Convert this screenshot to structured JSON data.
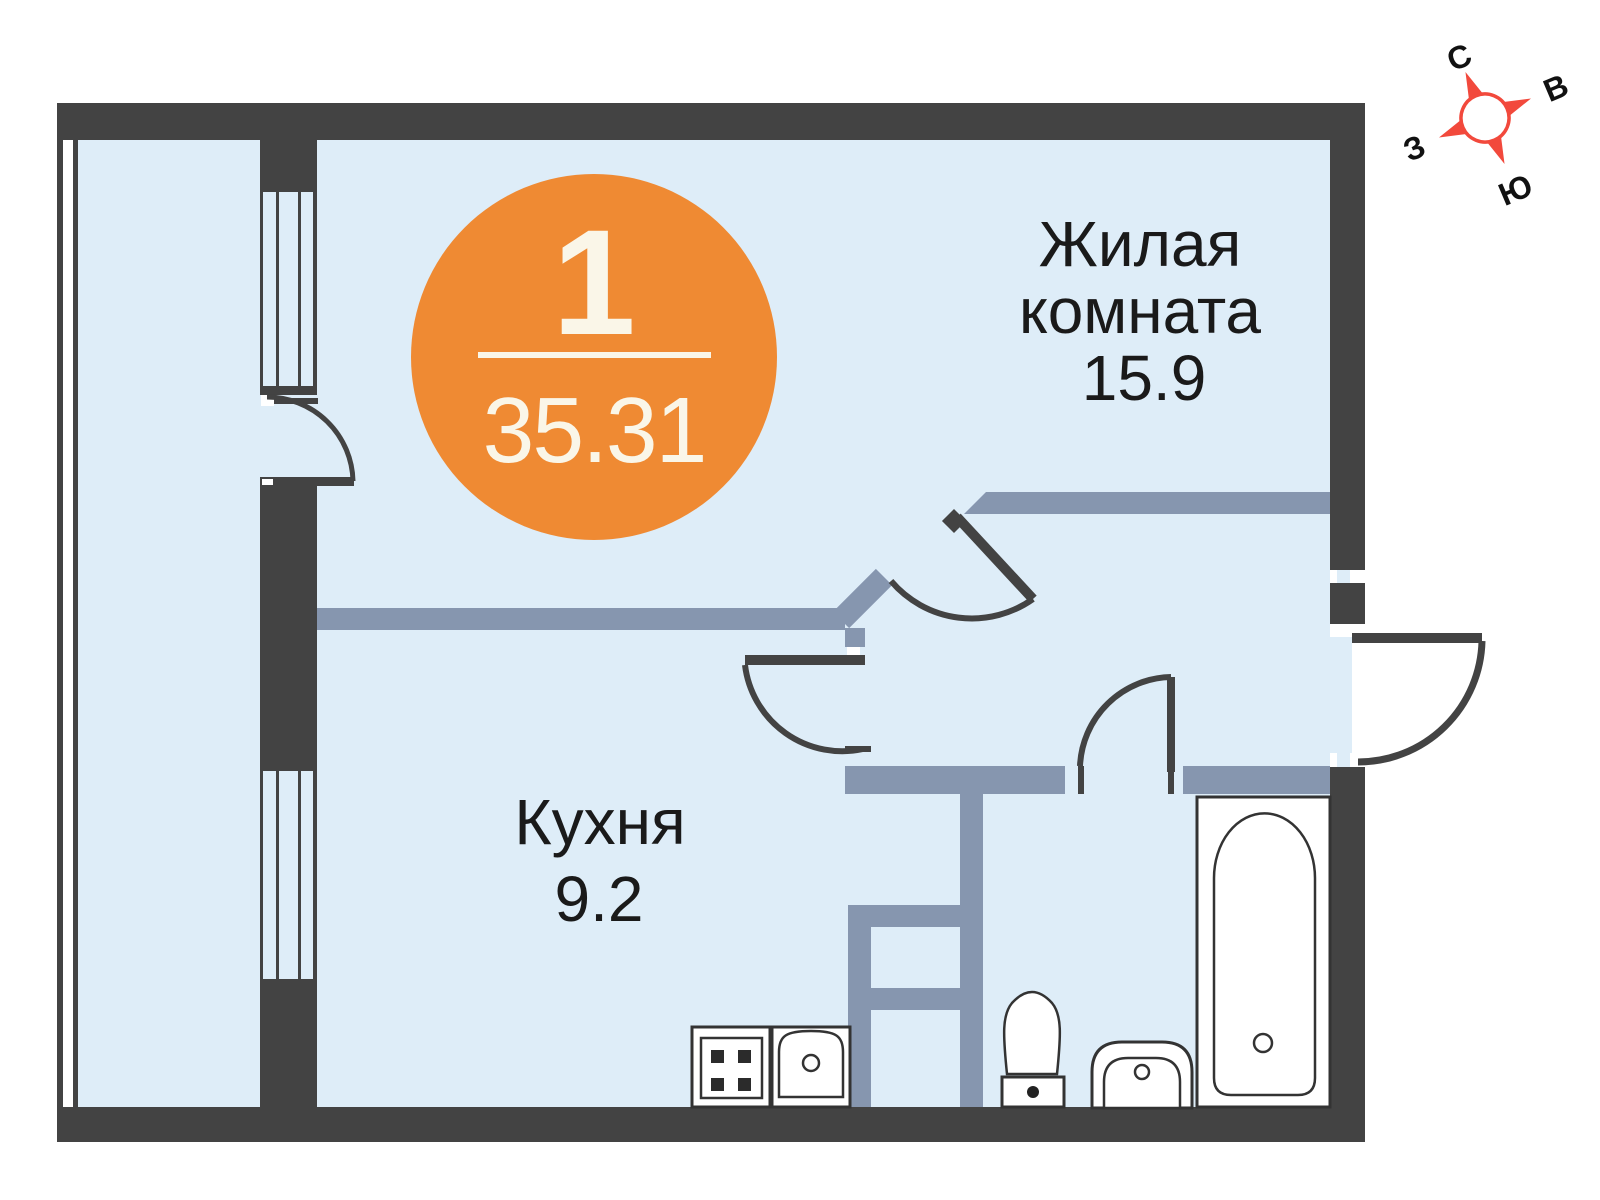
{
  "badge": {
    "rooms_count": "1",
    "total_area": "35.31"
  },
  "rooms": {
    "living": {
      "label_line1": "Жилая",
      "label_line2": "комната",
      "area": "15.9"
    },
    "kitchen": {
      "label": "Кухня",
      "area": "9.2"
    }
  },
  "compass": {
    "north": "С",
    "east": "В",
    "south": "Ю",
    "west": "З"
  },
  "fixtures": {
    "bathtub": "bathtub",
    "toilet": "toilet",
    "washbasin": "washbasin",
    "stove": "stove",
    "kitchen_sink": "kitchen-sink"
  },
  "colors": {
    "wall_dark": "#434343",
    "wall_interior": "#8696AF",
    "floor": "#DEEDF8",
    "outside": "#FFFFFF",
    "badge_orange": "#EF8A33",
    "badge_text": "#FAF6E8",
    "compass_red": "#F2493C",
    "label_text": "#1A1A1A"
  }
}
